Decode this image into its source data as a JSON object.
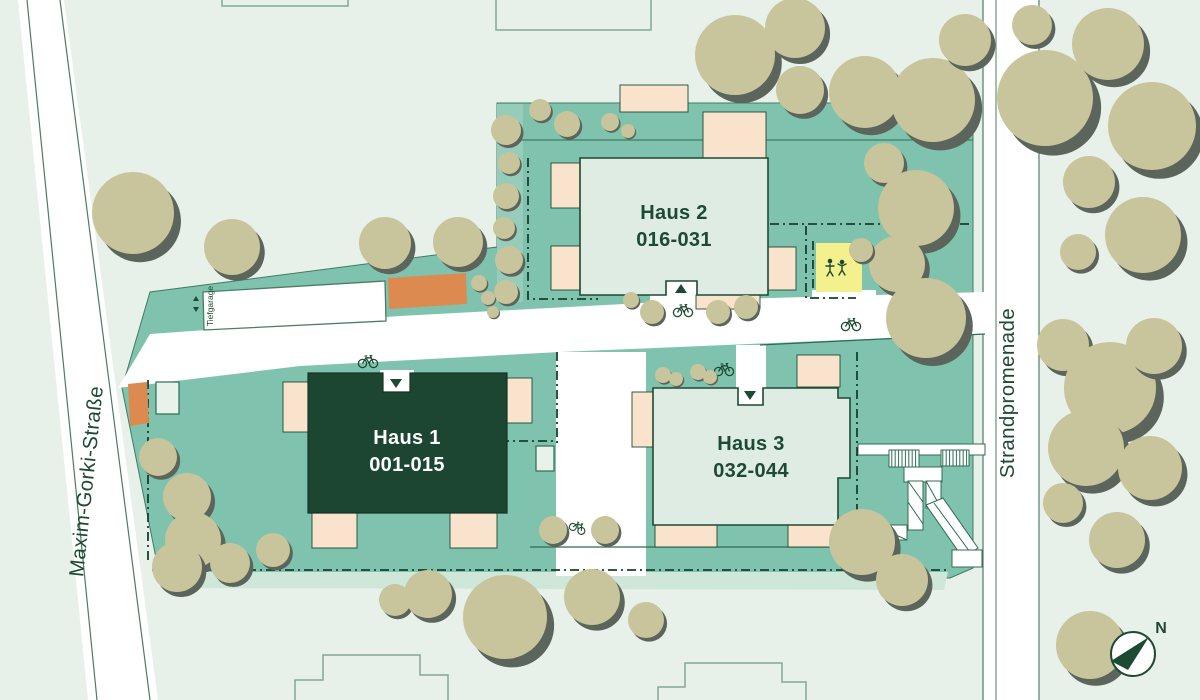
{
  "plan": {
    "buildings": [
      {
        "name": "Haus 1",
        "units": "001-015"
      },
      {
        "name": "Haus 2",
        "units": "016-031"
      },
      {
        "name": "Haus 3",
        "units": "032-044"
      }
    ],
    "streets": {
      "west": "Maxim-Gorki-Straße",
      "east": "Strandpromenade"
    },
    "garage": {
      "label": "Tiefgarage"
    },
    "compass": {
      "label": "N"
    },
    "icons": {
      "bicycle": "bicycle-icon",
      "playground": "playground-icon",
      "entrance_arrow": "entrance-arrow-icon",
      "stairs": "stairs-icon",
      "tree": "tree-icon",
      "compass": "compass-icon"
    },
    "colors": {
      "background": "#e7f0e9",
      "site": "#7fc3af",
      "building_light": "#dfece4",
      "building_dark": "#1c4631",
      "balcony": "#fae3cc",
      "garage_ramp_marker": "#dd8a50",
      "playground": "#f4f08d",
      "tree": "#c8c49b",
      "tree_shadow": "#5c655c",
      "ink": "#1d4a33",
      "path": "#ffffff"
    }
  }
}
